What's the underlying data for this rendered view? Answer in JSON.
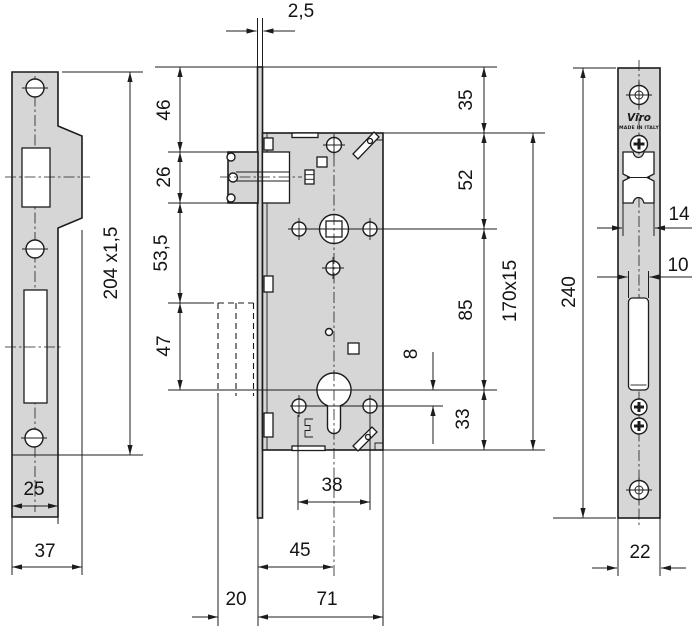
{
  "drawing": {
    "type": "technical-drawing",
    "subject": "mortise lock dimensional drawing",
    "colors": {
      "plate_fill": "#d6d6d6",
      "line": "#1c1c1c",
      "background": "#ffffff"
    },
    "brand": {
      "name": "Viro",
      "origin": "MADE IN ITALY"
    },
    "dims": {
      "faceplate_thickness": "2,5",
      "strike_plate": "204 x1,5",
      "strike_inner_width": "25",
      "strike_width": "37",
      "top_to_latch": "46",
      "latch_height": "26",
      "latch_to_handle": "53,5",
      "handle_zone": "47",
      "top_margin": "35",
      "to_follower": "52",
      "follower_to_cylinder": "85",
      "cylinder_to_bottom": "33",
      "hole_offset": "8",
      "case_size": "170x15",
      "faceplate_length": "240",
      "latch_cutout_width": "14",
      "bolt_cutout_width": "10",
      "screw_span": "38",
      "backset": "45",
      "case_depth": "71",
      "protrusion": "20",
      "faceplate_width": "22"
    }
  }
}
